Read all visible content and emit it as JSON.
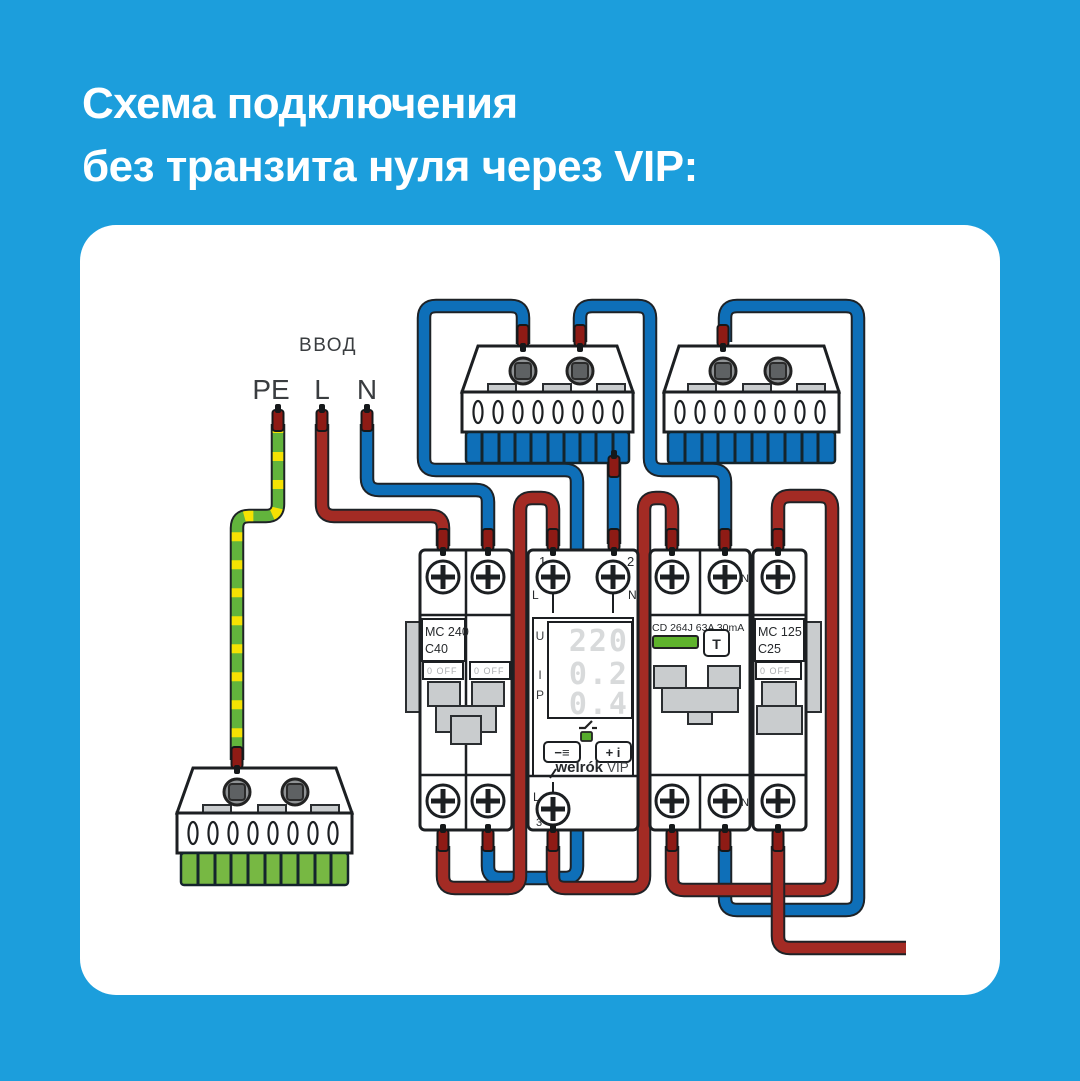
{
  "title": {
    "line1": "Схема подключения",
    "line2": "без транзита нуля через VIP:"
  },
  "input": {
    "group_label": "ВВОД",
    "pe": "PE",
    "l": "L",
    "n": "N"
  },
  "mc240": {
    "model": "MC 240",
    "rating": "C40",
    "off_label": "0 OFF"
  },
  "vip": {
    "t1_num": "1",
    "t1_letter": "L",
    "t2_num": "2",
    "t2_letter": "N",
    "u": "U",
    "i": "I",
    "p": "P",
    "u_val": "220",
    "i_val": "0.2",
    "p_val": "0.4",
    "btn_minus": "−≡",
    "btn_plus": "+ i",
    "brand": "welrók",
    "model": "VIP",
    "t3_letter": "L",
    "t3_num": "3"
  },
  "rcd": {
    "model": "CD 264J 63A 30mA",
    "test": "T",
    "n_top": "N",
    "n_bottom": "N"
  },
  "mc125": {
    "model": "MC 125",
    "rating": "C25",
    "off_label": "0 OFF"
  },
  "colors": {
    "bg": "#1C9EDC",
    "panel": "#FFFFFF",
    "outline": "#1E2226",
    "textDark": "#3A3D40",
    "devStroke": "#1C1F22",
    "wireRed": "#A32B24",
    "wireBlue": "#0E6FB8",
    "peGreen": "#62B43C",
    "peYellow": "#F5E203",
    "ferrule": "#8E1B15",
    "grayPart": "#C9CCCE",
    "teethGreen": "#77B843",
    "ledGreen": "#56AC2C",
    "rcdGreen": "#5FB32C",
    "digit": "#D8DADB"
  }
}
